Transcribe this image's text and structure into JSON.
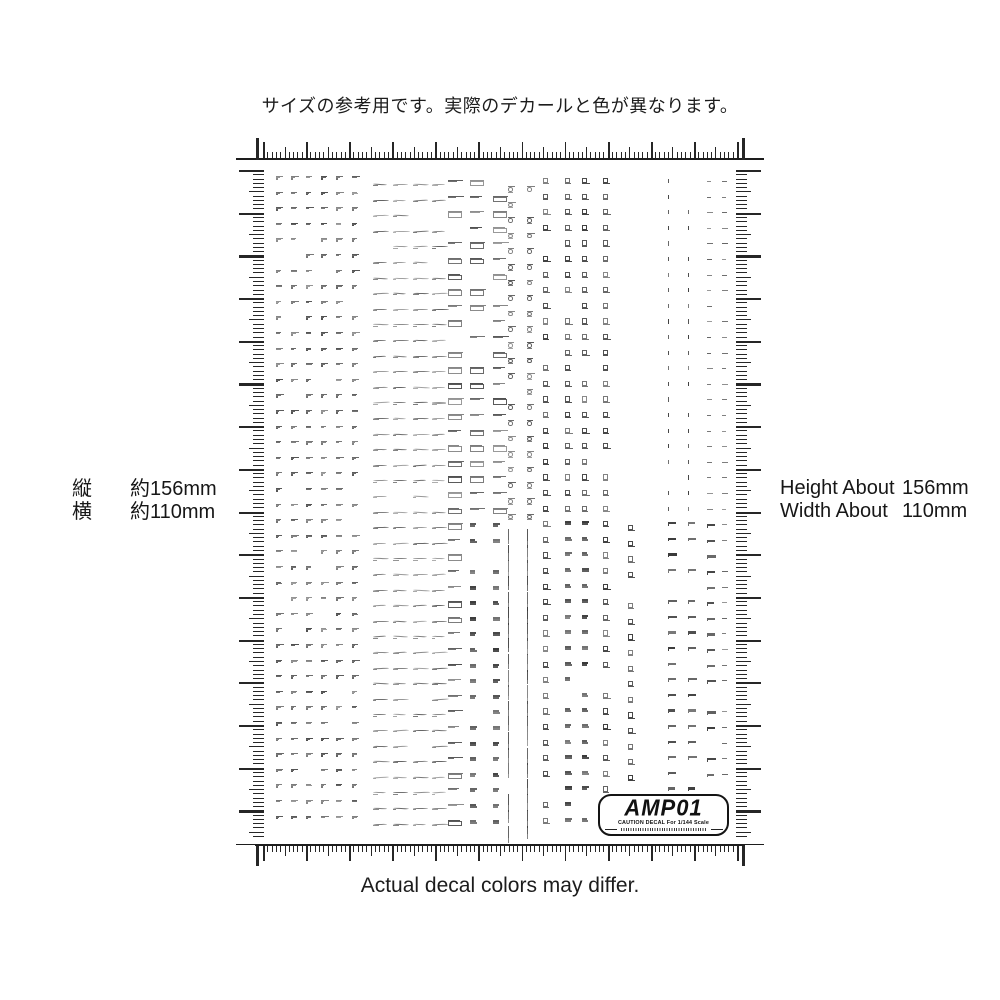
{
  "page": {
    "background": "#ffffff",
    "ink": "#1a1a1a"
  },
  "captions": {
    "top": "サイズの参考用です。実際のデカールと色が異なります。",
    "bottom": "Actual decal colors may differ."
  },
  "size_labels": {
    "left": [
      {
        "label": "縦",
        "value": "約156mm"
      },
      {
        "label": "横",
        "value": "約110mm"
      }
    ],
    "right": [
      {
        "label": "Height About",
        "value": "156mm"
      },
      {
        "label": "Width About",
        "value": "110mm"
      }
    ]
  },
  "ruler": {
    "width_mm": 110,
    "height_mm": 156,
    "minor_step_mm": 1,
    "mid_step_mm": 5,
    "major_step_mm": 10
  },
  "sheet": {
    "x": 256,
    "y": 160,
    "w": 488,
    "h": 684
  },
  "logo": {
    "text": "AMP01",
    "caption": "CAUTION DECAL For 1/144 Scale"
  },
  "decal_grid": {
    "seed": 1337,
    "grid_top": 16,
    "row_height": 15.6,
    "mark_skip_chance": 0.06,
    "alt_switch_row": 22,
    "logo_zone": {
      "x_min": 342,
      "y_max": 628
    },
    "columns": [
      {
        "x": 20,
        "w": 10,
        "phase": 0,
        "style": "micro-text"
      },
      {
        "x": 35,
        "w": 10,
        "phase": 0,
        "style": "micro-text"
      },
      {
        "x": 50,
        "w": 10,
        "phase": 0,
        "style": "micro-text"
      },
      {
        "x": 65,
        "w": 10,
        "phase": 0,
        "style": "micro-text"
      },
      {
        "x": 80,
        "w": 10,
        "phase": 0,
        "style": "micro-text"
      },
      {
        "x": 96,
        "w": 10,
        "phase": 0,
        "style": "micro-text"
      },
      {
        "x": 117,
        "w": 17,
        "phase": 8,
        "style": "swoosh"
      },
      {
        "x": 137,
        "w": 17,
        "phase": 8,
        "style": "swoosh"
      },
      {
        "x": 157,
        "w": 17,
        "phase": 8,
        "style": "swoosh"
      },
      {
        "x": 176,
        "w": 17,
        "phase": 8,
        "style": "swoosh"
      },
      {
        "x": 192,
        "w": 17,
        "phase": 4,
        "style": "boxed-label",
        "alt": "boxed-label"
      },
      {
        "x": 214,
        "w": 17,
        "phase": 4,
        "style": "boxed-label",
        "alt": "bar-stack"
      },
      {
        "x": 237,
        "w": 13,
        "phase": 4,
        "style": "boxed-label",
        "alt": "bar-stack"
      },
      {
        "x": 252,
        "w": 13,
        "phase": 10,
        "style": "ring-label",
        "alt": "vertical-label"
      },
      {
        "x": 271,
        "w": 13,
        "phase": 10,
        "style": "ring-label",
        "alt": "vertical-label"
      },
      {
        "x": 287,
        "w": 14,
        "phase": 2,
        "style": "cross-box",
        "alt": "cross-box"
      },
      {
        "x": 309,
        "w": 14,
        "phase": 2,
        "style": "cross-box",
        "alt": "bar-stack"
      },
      {
        "x": 326,
        "w": 14,
        "phase": 2,
        "style": "cross-box",
        "alt": "bar-stack"
      },
      {
        "x": 347,
        "w": 14,
        "phase": 2,
        "style": "cross-box",
        "alt": "cross-box"
      },
      {
        "x": 372,
        "w": 21,
        "phase": 6,
        "style": "number-band",
        "alt": "cross-box"
      },
      {
        "x": 396,
        "w": 21,
        "phase": 6,
        "style": "number-band",
        "alt": "number-band"
      },
      {
        "x": 412,
        "w": 13,
        "phase": 3,
        "style": "arrow-dots",
        "alt": "wedge"
      },
      {
        "x": 432,
        "w": 13,
        "phase": 3,
        "style": "arrow-dots",
        "alt": "wedge"
      },
      {
        "x": 451,
        "w": 9,
        "phase": 5,
        "style": "triangle-stack",
        "alt": "wedge"
      },
      {
        "x": 466,
        "w": 9,
        "phase": 5,
        "style": "triangle-stack",
        "alt": "triangle-stack"
      }
    ]
  }
}
